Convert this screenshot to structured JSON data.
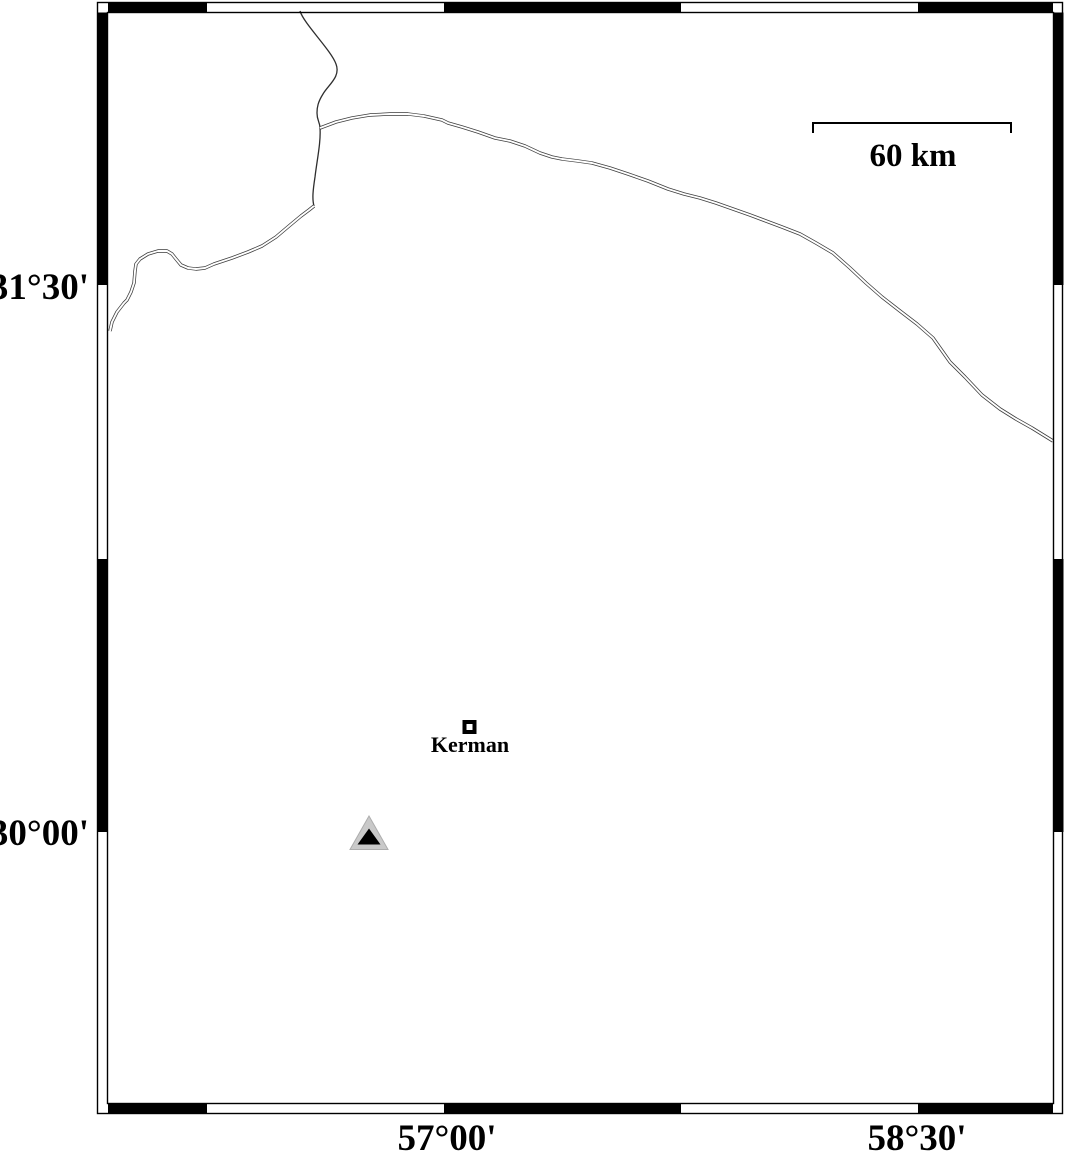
{
  "map": {
    "kind": "geographic-map",
    "frame": {
      "lat_labels": [
        {
          "text": "31°30'"
        },
        {
          "text": "30°00'"
        }
      ],
      "lon_labels": [
        {
          "text": "57°00'"
        },
        {
          "text": "58°30'"
        }
      ]
    },
    "scale_bar": {
      "label": "60 km"
    },
    "markers": {
      "city": {
        "label": "Kerman"
      },
      "station": {
        "shape": "triangle"
      }
    },
    "colors": {
      "frame": "#000000",
      "line": "#3c3c3c",
      "road_core": "#ffffff",
      "triangle_fill": "#c9c9c9",
      "triangle_edge": "#adadad",
      "triangle_core": "#000000",
      "background": "#ffffff"
    }
  }
}
